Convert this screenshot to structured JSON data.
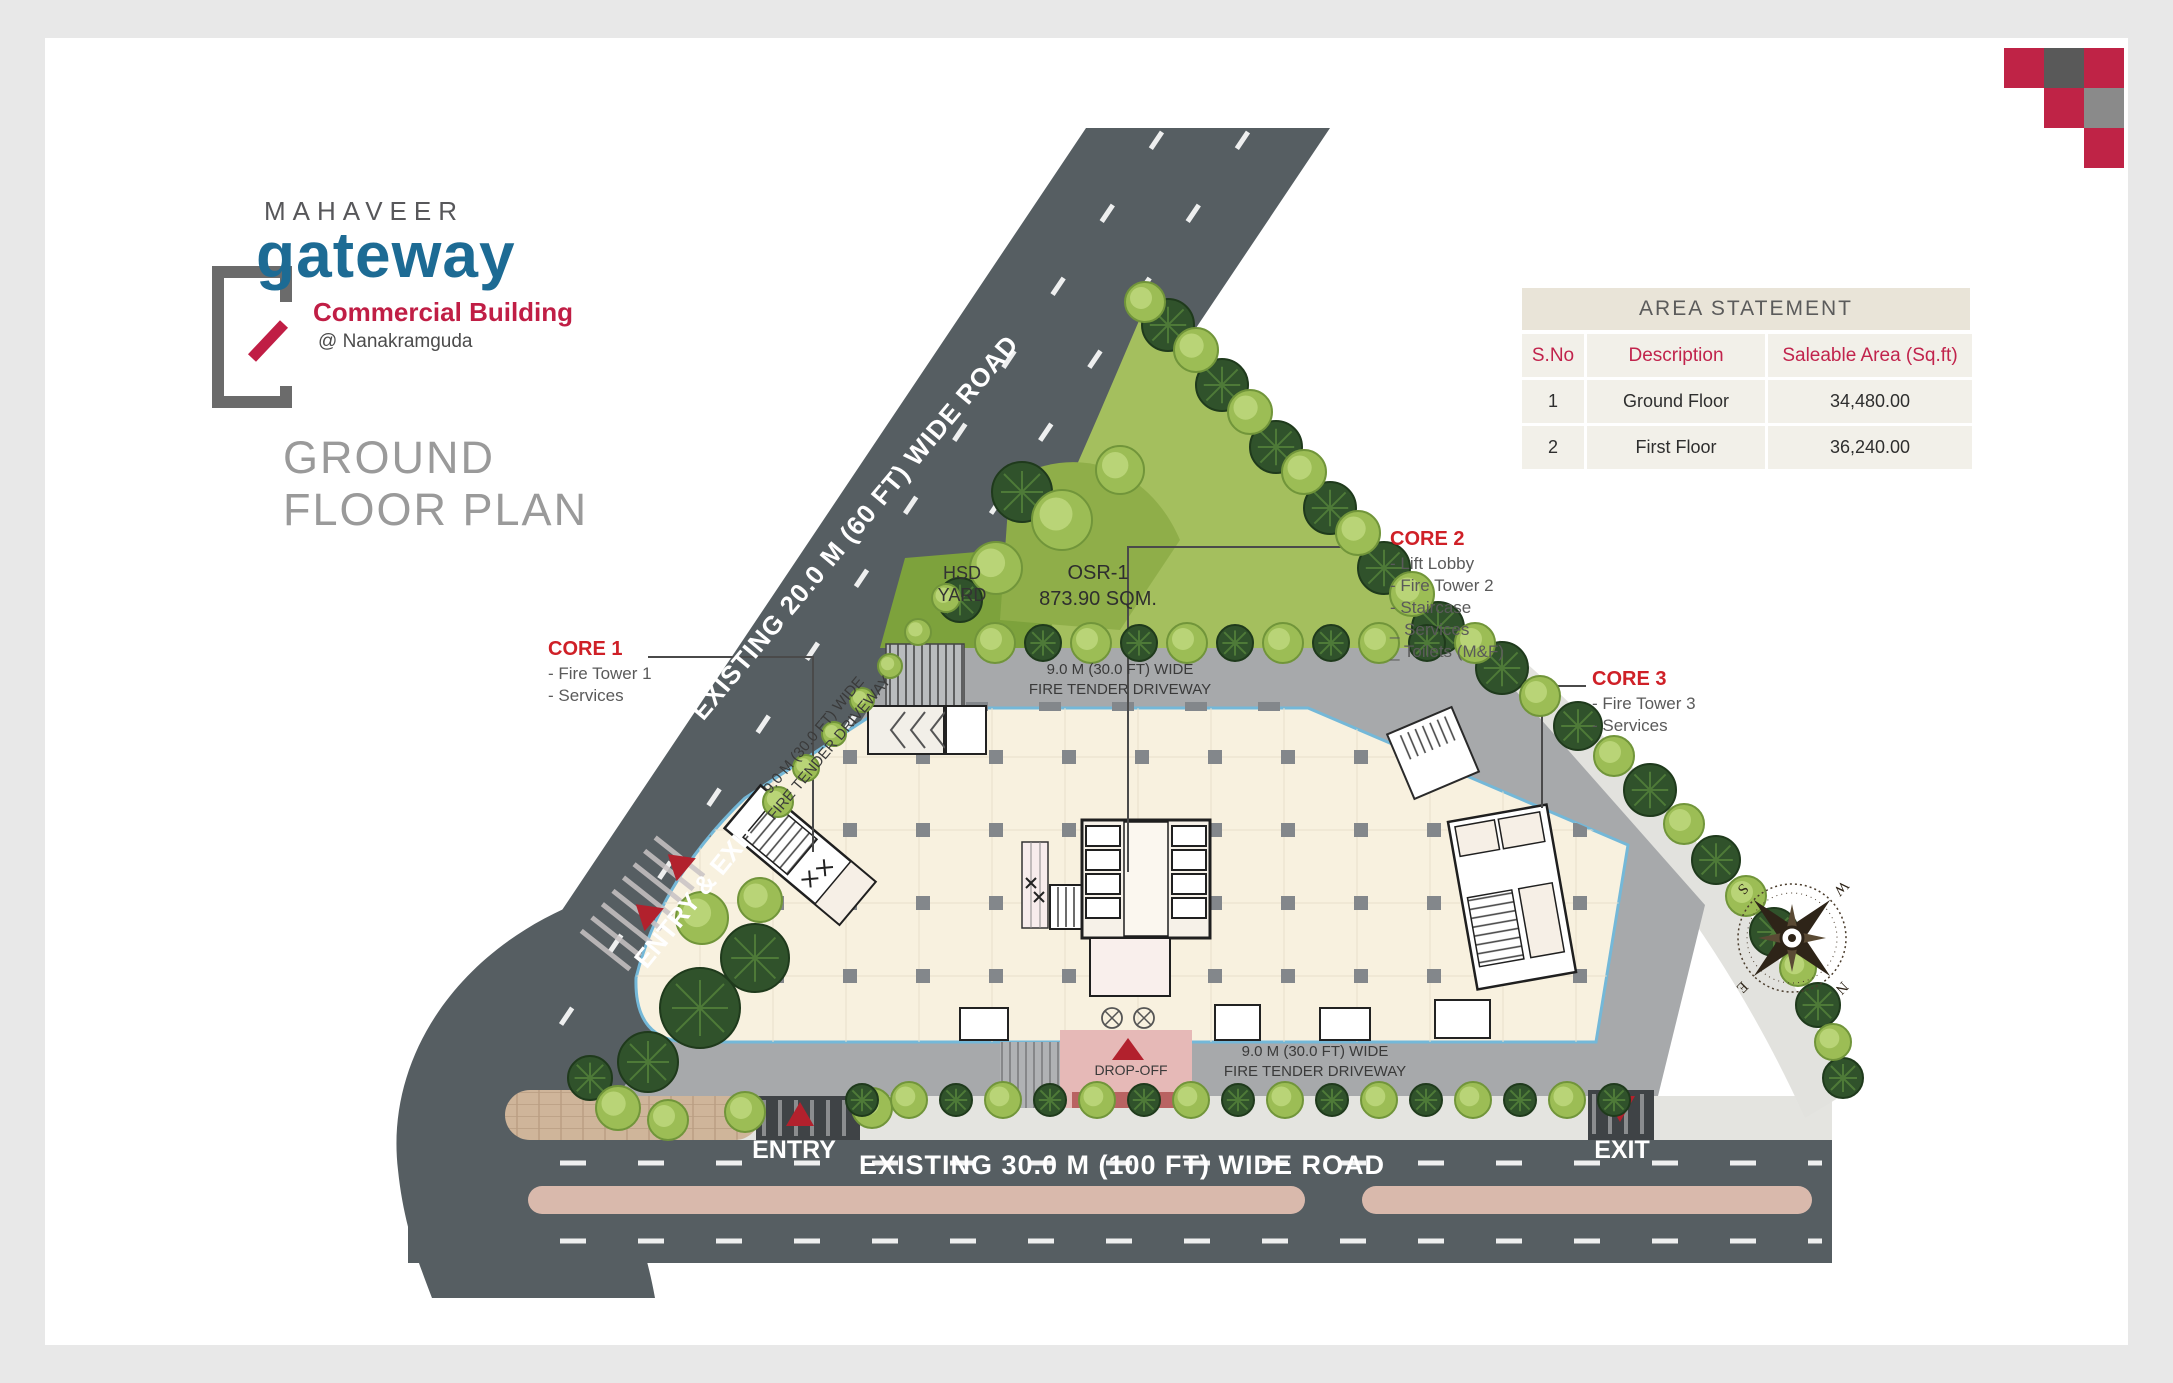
{
  "logo": {
    "brand": "MAHAVEER",
    "name": "gateway",
    "subtitle": "Commercial Building",
    "location": "@ Nanakramguda"
  },
  "heading": {
    "line1": "GROUND",
    "line2": "FLOOR PLAN"
  },
  "area_statement": {
    "title": "AREA STATEMENT",
    "columns": [
      "S.No",
      "Description",
      "Saleable Area (Sq.ft)"
    ],
    "rows": [
      {
        "sno": "1",
        "description": "Ground Floor",
        "area": "34,480.00"
      },
      {
        "sno": "2",
        "description": "First Floor",
        "area": "36,240.00"
      }
    ]
  },
  "cores": {
    "core1": {
      "title": "CORE 1",
      "items": [
        "- Fire Tower 1",
        "- Services"
      ]
    },
    "core2": {
      "title": "CORE 2",
      "items": [
        "- Lift Lobby",
        "- Fire Tower 2",
        "- Staircase",
        "_ Services",
        "_ Toilets (M&F)"
      ]
    },
    "core3": {
      "title": "CORE 3",
      "items": [
        "- Fire Tower 3",
        "- Services"
      ]
    }
  },
  "roads": {
    "diagonal": "EXISTING 20.0 M (60 FT)  WIDE ROAD",
    "bottom": "EXISTING 30.0 M (100 FT)  WIDE ROAD"
  },
  "site_labels": {
    "hsd_yard_line1": "HSD",
    "hsd_yard_line2": "YARD",
    "osr_line1": "OSR-1",
    "osr_line2": "873.90 SQM.",
    "driveway_line1": "9.0 M (30.0 FT) WIDE",
    "driveway_line2": "FIRE TENDER DRIVEWAY",
    "entry_exit": "ENTRY & EXIT",
    "entry": "ENTRY",
    "exit": "EXIT",
    "drop_off": "DROP-OFF"
  },
  "compass": {
    "n": "N",
    "e": "E",
    "s": "S",
    "w": "W"
  },
  "colors": {
    "accent_red": "#c0223f",
    "logo_blue": "#1d6b94",
    "road_gray": "#565e62",
    "driveway_gray": "#a7a9ab",
    "floor_cream": "#f8f1df",
    "floor_edge_blue": "#74b8d8",
    "landscape_green": "#9cbd55",
    "median_pink": "#d9b9ac",
    "table_beige": "#e9e4d8",
    "dropoff_pink": "#e6b9b7"
  }
}
